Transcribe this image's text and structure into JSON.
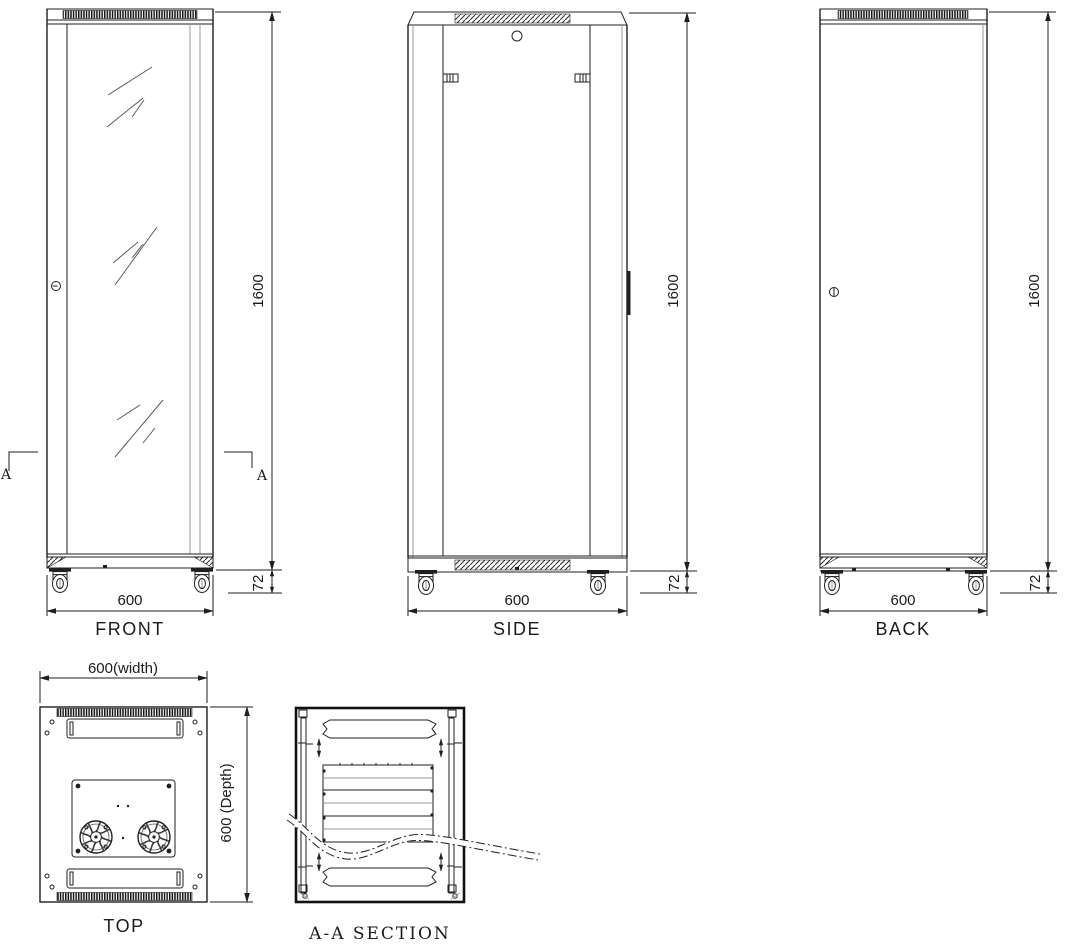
{
  "front": {
    "label": "FRONT",
    "width": "600",
    "height": "1600",
    "base": "72",
    "mark_left": "A",
    "mark_right": "A"
  },
  "side": {
    "label": "SIDE",
    "width": "600",
    "height": "1600",
    "base": "72"
  },
  "back": {
    "label": "BACK",
    "width": "600",
    "height": "1600",
    "base": "72"
  },
  "top": {
    "label": "TOP",
    "width": "600(width)",
    "depth": "600 (Depth)"
  },
  "section": {
    "label": "A-A  SECTION"
  },
  "colors": {
    "line": "#1f1f1f",
    "muted_line": "#9a9a9a",
    "background": "#ffffff"
  }
}
